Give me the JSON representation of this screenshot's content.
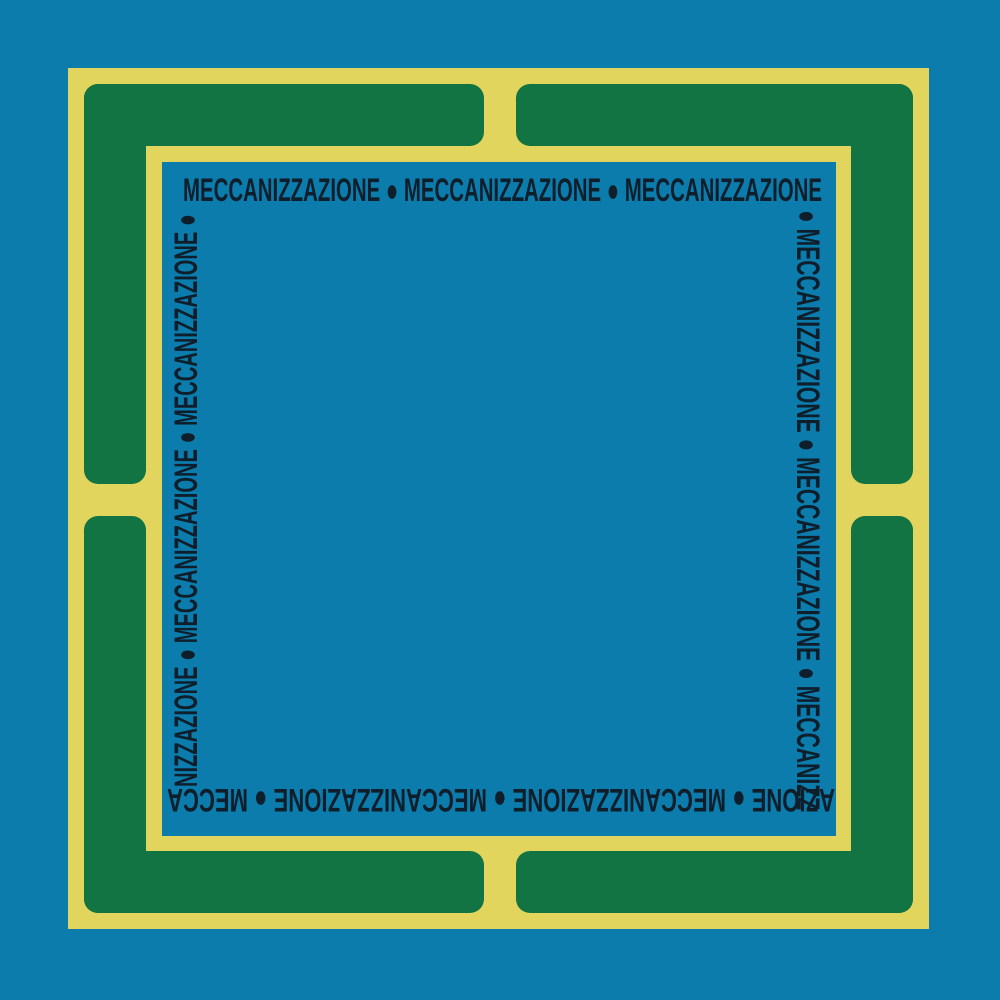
{
  "artwork": {
    "title_word": "MECCANIZZAZIONE",
    "description": "Square cover graphic: yellow ring frame with four green corner bars on a blue field, word ring repeated clockwise with bullet separators",
    "separator_icon": "filled-circle-bullet"
  },
  "colors": {
    "background": "#0B7CAC",
    "frame_yellow": "#E2D55E",
    "frame_green": "#12744238",
    "frame_green_fix": "#127442",
    "text": "#0F1E2B"
  },
  "ring_text": {
    "word": "MECCANIZZAZIONE",
    "separator": "●",
    "top": "MECCANIZZAZIONE ● MECCANIZZAZIONE ● MECCANIZZAZIONE",
    "right": "● MECCANIZZAZIONE ● MECCANIZZAZIONE ● MECCANIZZ",
    "bottom": "AZIONE ● MECCANIZZAZIONE ● MECCANIZZAZIONE ● MECCA",
    "left": "NIZZAZIONE ● MECCANIZZAZIONE ● MECCANIZZAZIONE ●"
  }
}
